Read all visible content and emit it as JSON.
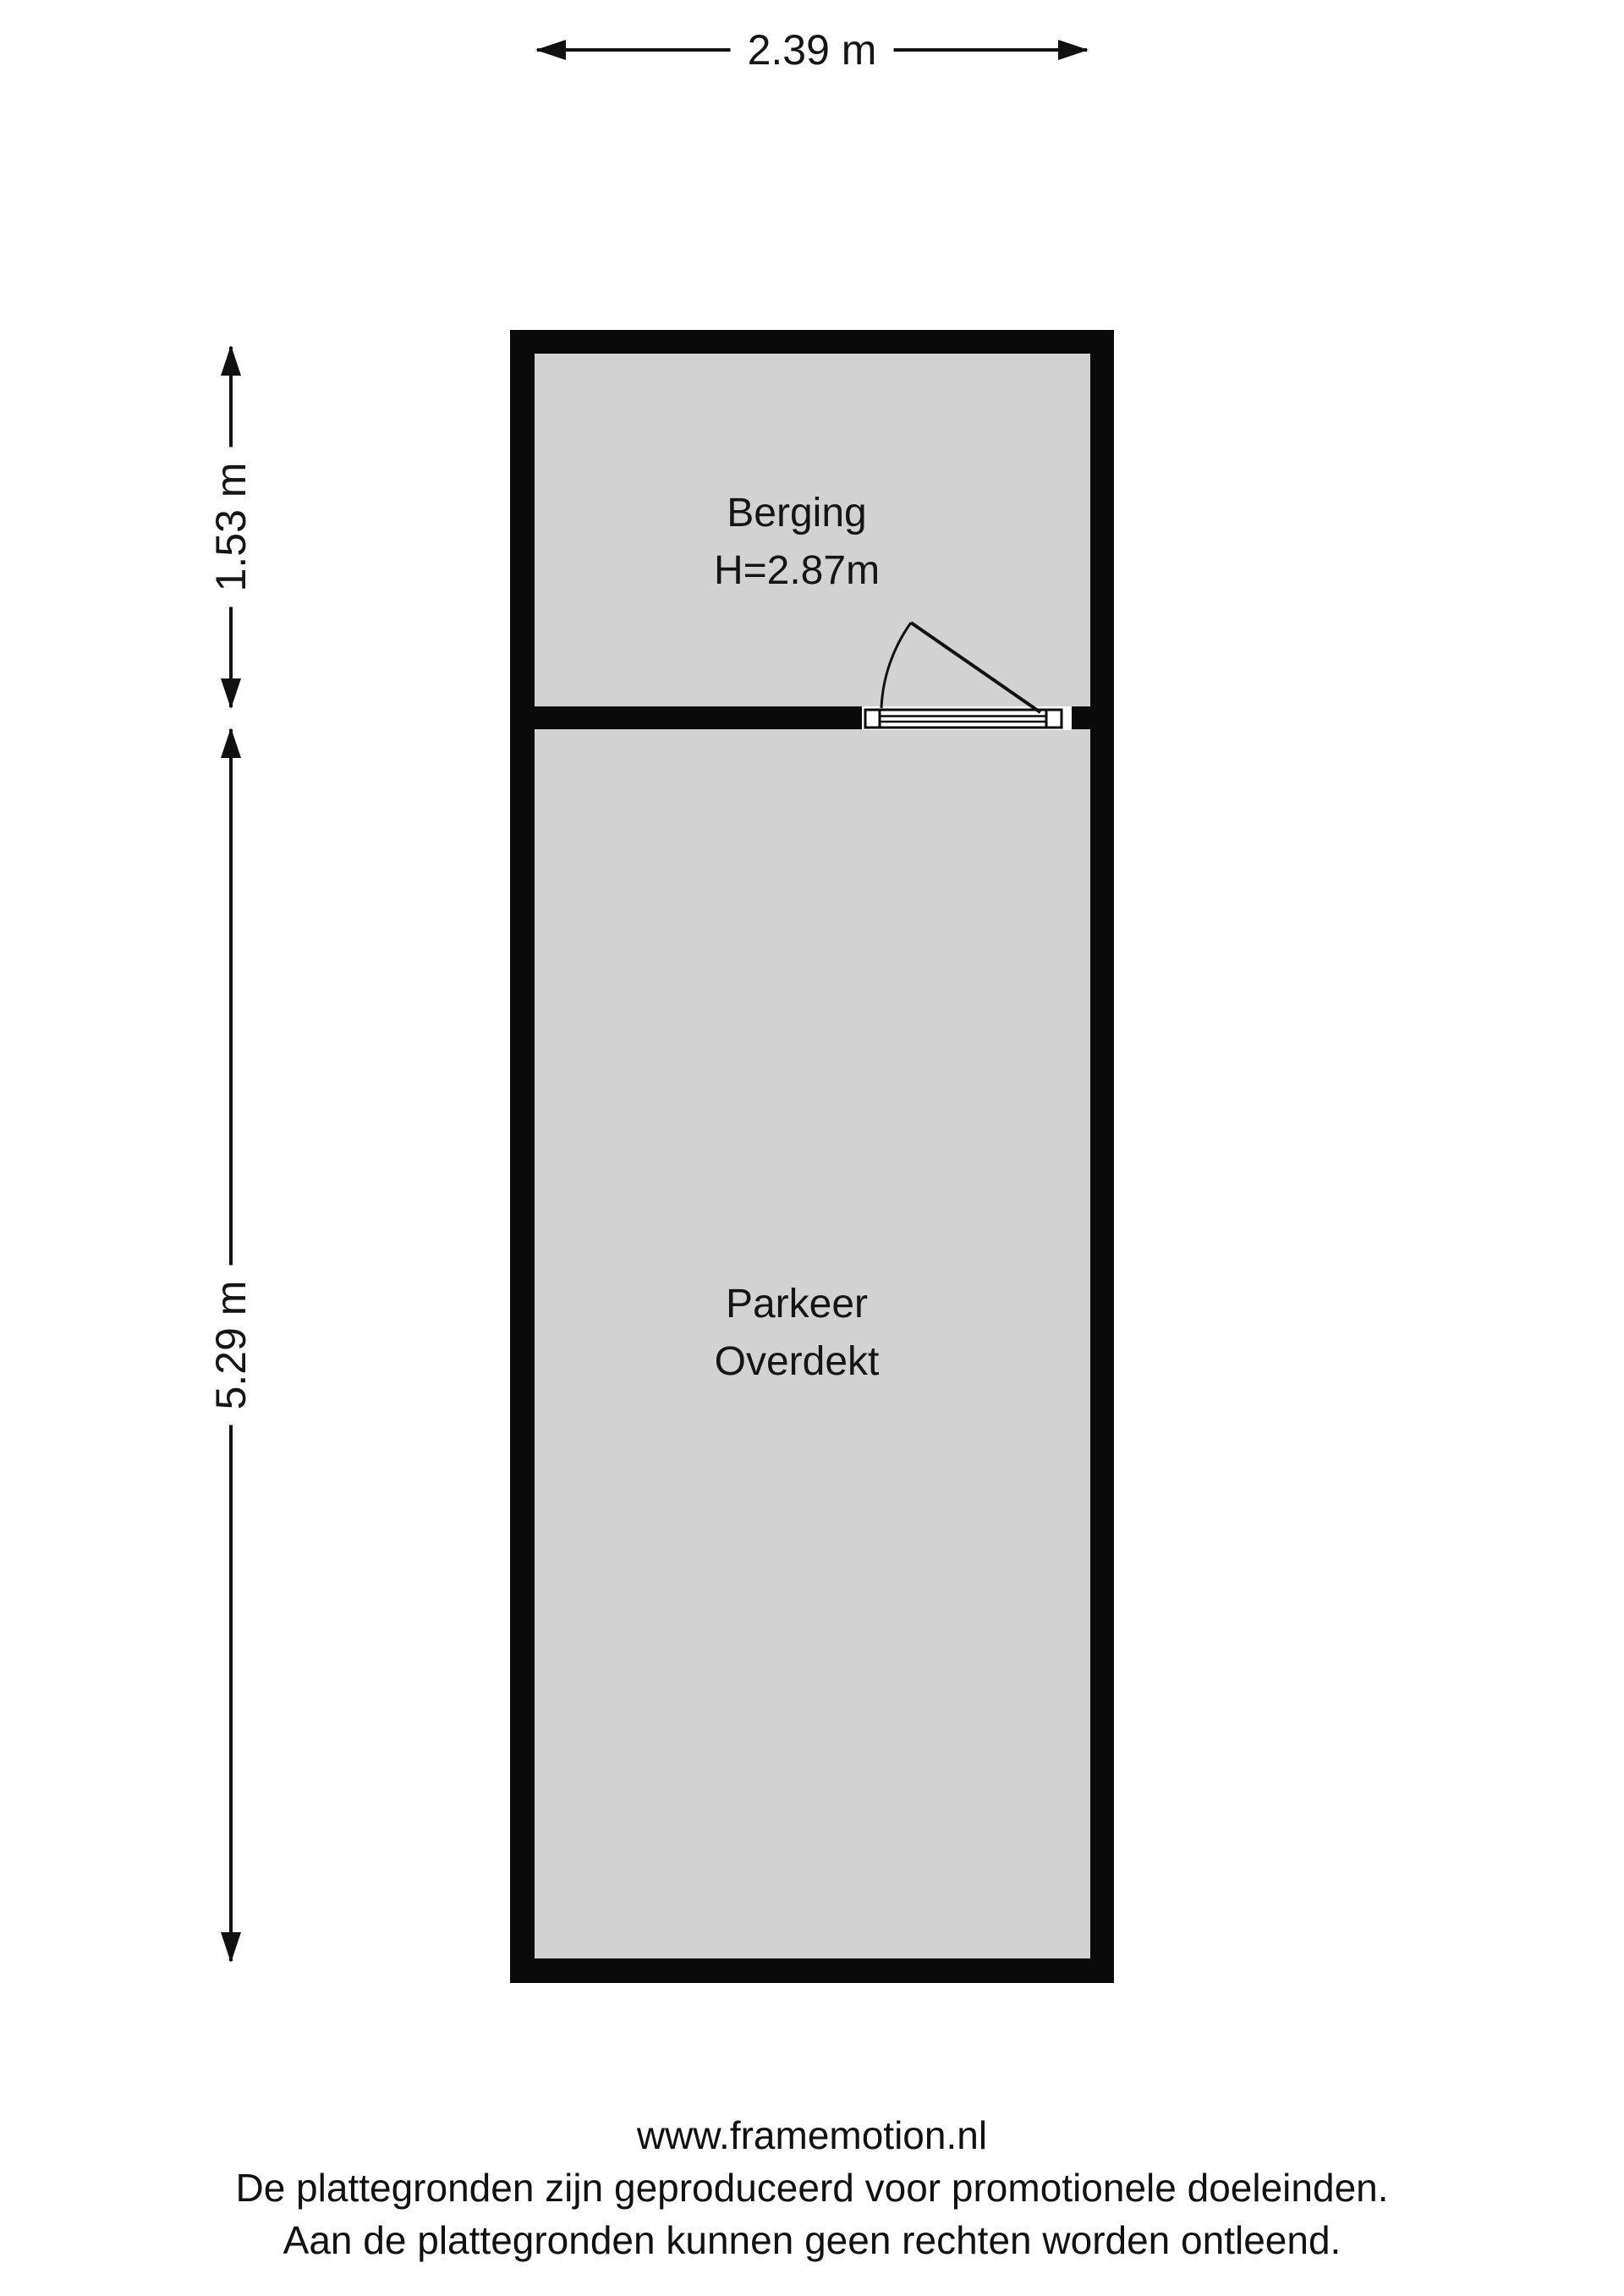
{
  "colors": {
    "background": "#ffffff",
    "wall": "#0a0a0a",
    "floor": "#d2d2d2",
    "line": "#111111"
  },
  "dimensions": {
    "top_width": "2.39 m",
    "left_upper": "1.53 m",
    "left_lower": "5.29 m"
  },
  "rooms": [
    {
      "label": "Berging",
      "sublabel": "H=2.87m"
    },
    {
      "label": "Parkeer",
      "sublabel": "Overdekt"
    }
  ],
  "footer": {
    "website": "www.framemotion.nl",
    "disclaimer_line_1": "De plattegronden zijn geproduceerd voor promotionele doeleinden.",
    "disclaimer_line_2": "Aan de plattegronden kunnen geen rechten worden ontleend."
  }
}
